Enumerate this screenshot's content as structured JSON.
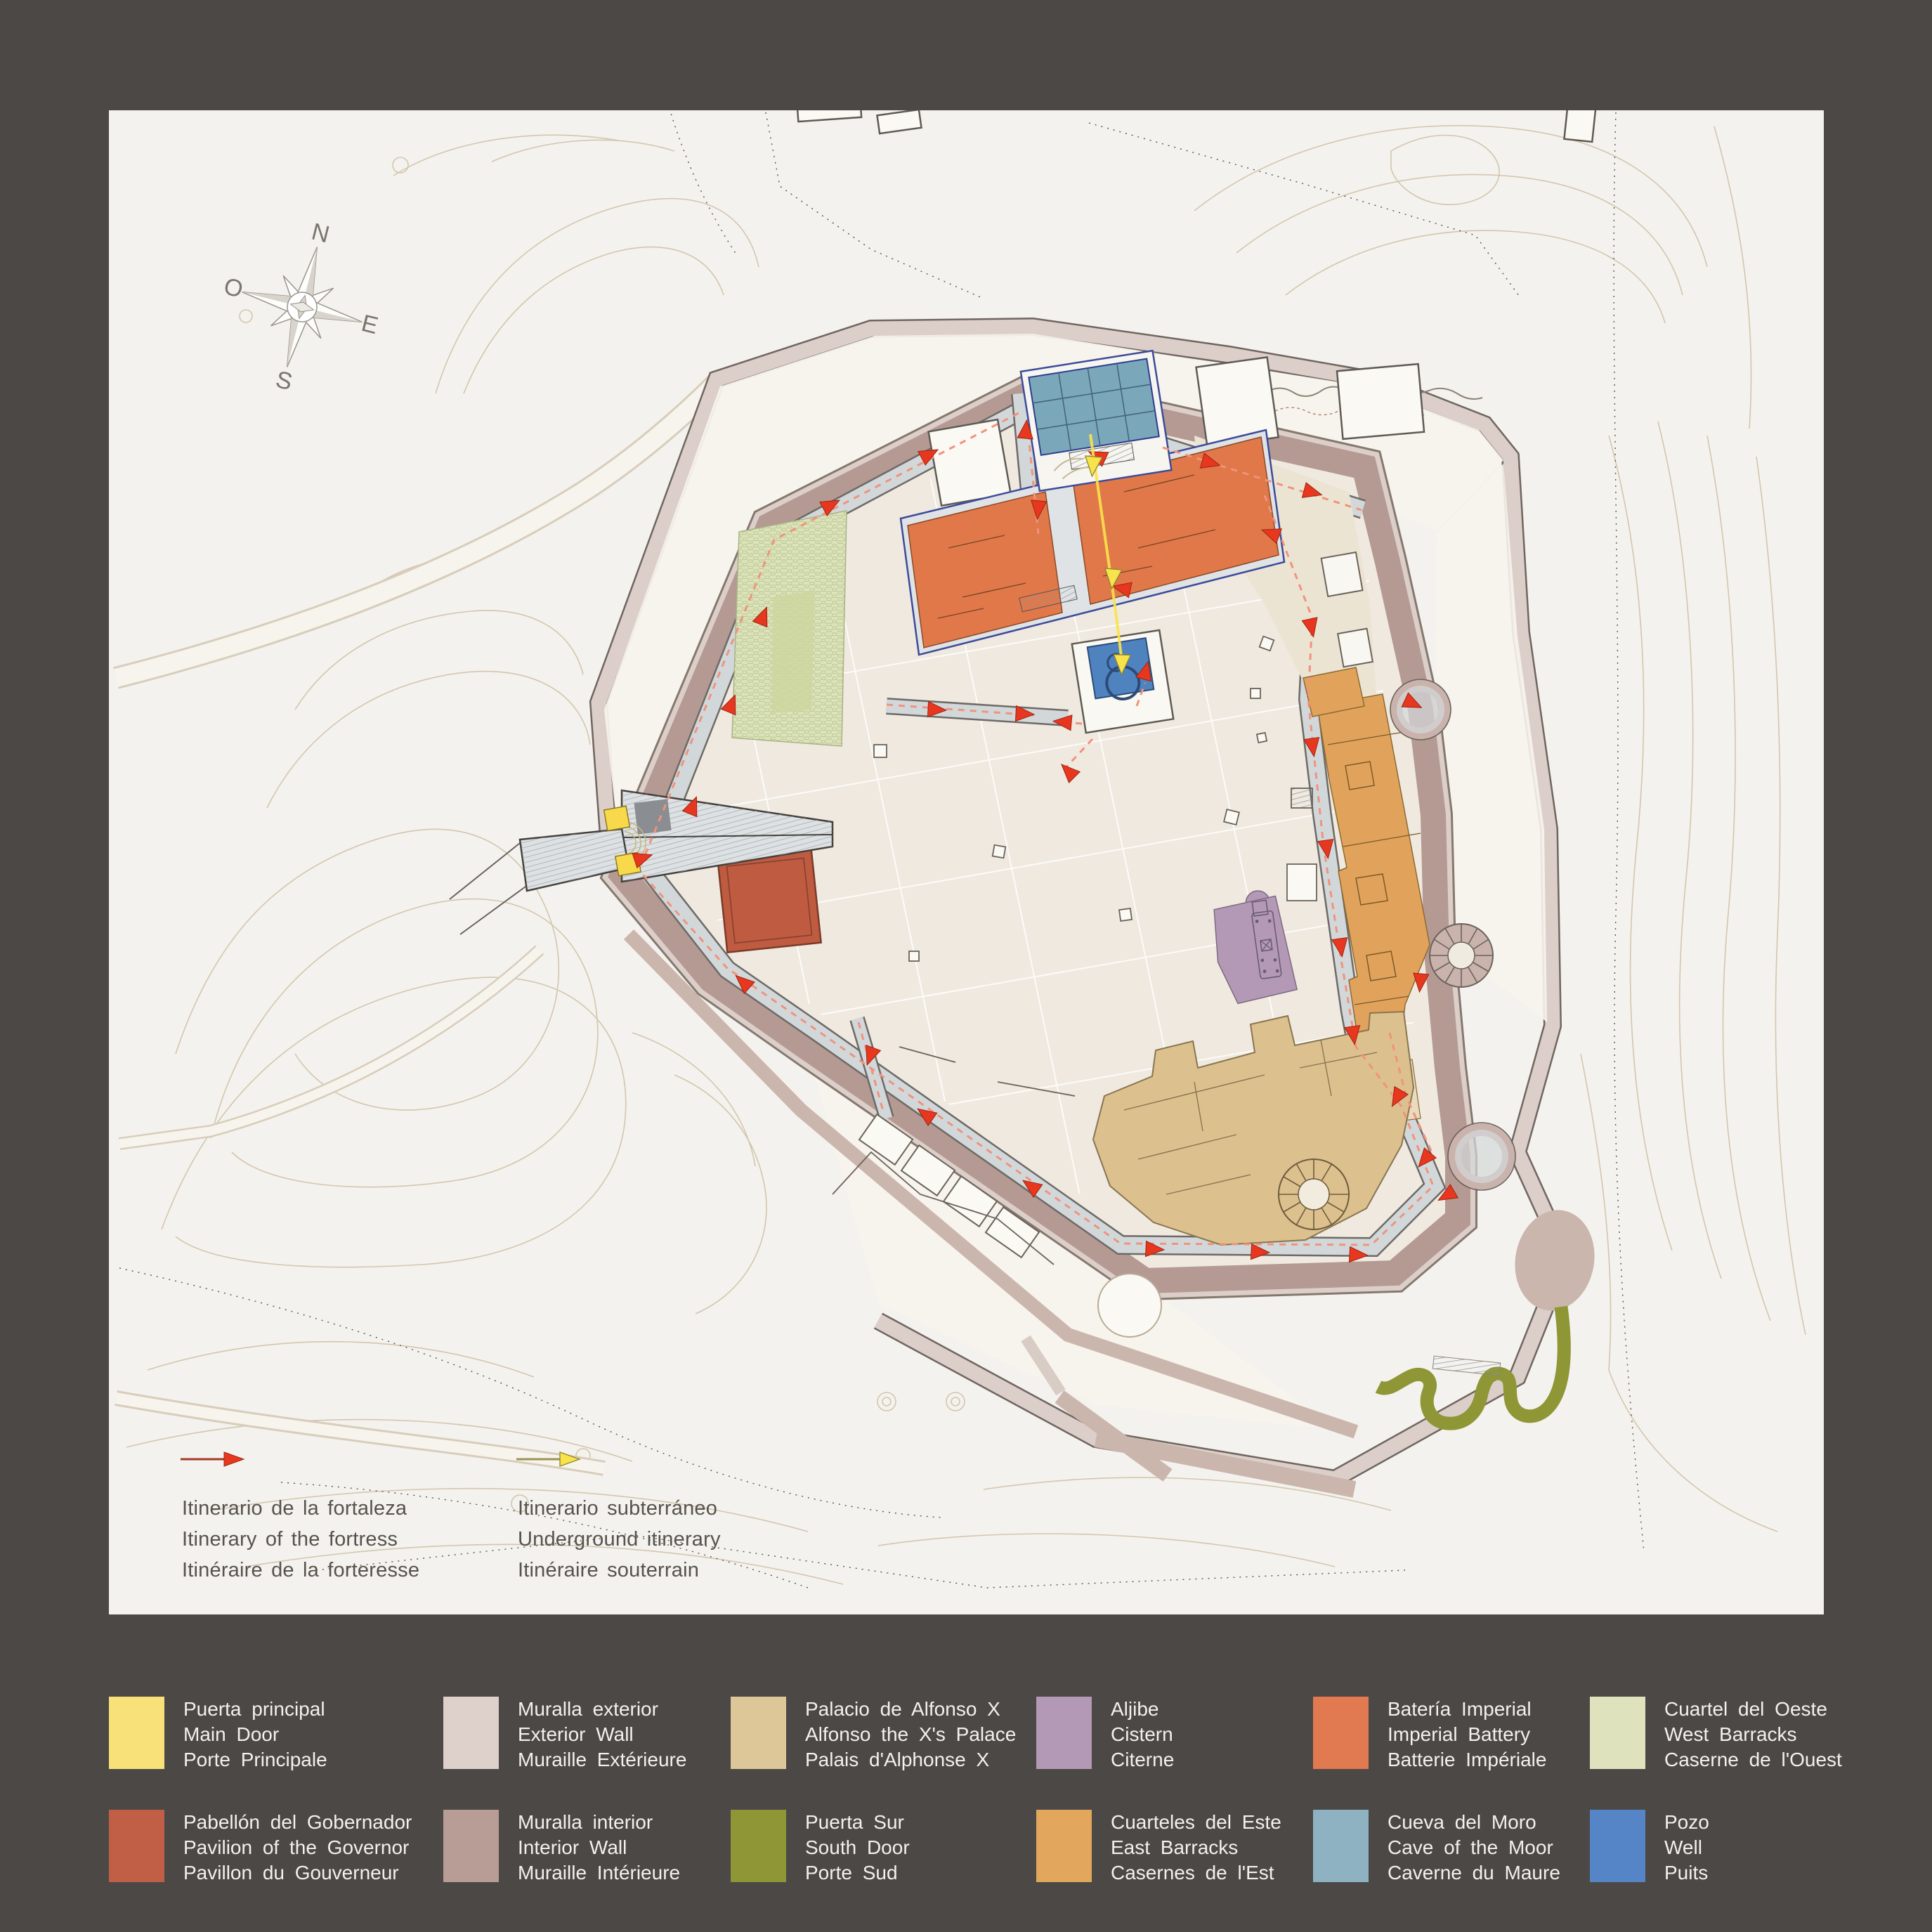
{
  "map": {
    "compass": {
      "n": "N",
      "e": "E",
      "s": "S",
      "o": "O"
    },
    "itinerary_legend": {
      "fortress": {
        "es": "Itinerario de la fortaleza",
        "en": "Itinerary of the fortress",
        "fr": "Itinéraire de la forteresse"
      },
      "underground": {
        "es": "Itinerario subterráneo",
        "en": "Underground itinerary",
        "fr": "Itinéraire souterrain"
      }
    }
  },
  "legend": {
    "items": [
      {
        "id": "puerta-principal",
        "color": "#f9e17a",
        "es": "Puerta principal",
        "en": "Main Door",
        "fr": "Porte Principale"
      },
      {
        "id": "pabellon-gobernador",
        "color": "#c05f45",
        "es": "Pabellón del Gobernador",
        "en": "Pavilion of the Governor",
        "fr": "Pavillon du Gouverneur"
      },
      {
        "id": "muralla-exterior",
        "color": "#ded0cb",
        "es": "Muralla exterior",
        "en": "Exterior Wall",
        "fr": "Muraille Extérieure"
      },
      {
        "id": "muralla-interior",
        "color": "#b79d96",
        "es": "Muralla interior",
        "en": "Interior Wall",
        "fr": "Muraille Intérieure"
      },
      {
        "id": "palacio-alfonso-x",
        "color": "#ddc697",
        "es": "Palacio de Alfonso X",
        "en": "Alfonso the X's Palace",
        "fr": "Palais d'Alphonse X"
      },
      {
        "id": "puerta-sur",
        "color": "#8f9636",
        "es": "Puerta Sur",
        "en": "South Door",
        "fr": "Porte Sud"
      },
      {
        "id": "aljibe",
        "color": "#b399b6",
        "es": "Aljibe",
        "en": "Cistern",
        "fr": "Citerne"
      },
      {
        "id": "cuarteles-este",
        "color": "#e2a65c",
        "es": "Cuarteles del Este",
        "en": "East Barracks",
        "fr": "Casernes de l'Est"
      },
      {
        "id": "bateria-imperial",
        "color": "#e17a50",
        "es": "Batería Imperial",
        "en": "Imperial Battery",
        "fr": "Batterie Impériale"
      },
      {
        "id": "cueva-moro",
        "color": "#8fb2c3",
        "es": "Cueva del Moro",
        "en": "Cave of the Moor",
        "fr": "Caverne du Maure"
      },
      {
        "id": "cuartel-oeste",
        "color": "#dfe3bd",
        "es": "Cuartel del Oeste",
        "en": "West Barracks",
        "fr": "Caserne de l'Ouest"
      },
      {
        "id": "pozo",
        "color": "#5585c6",
        "es": "Pozo",
        "en": "Well",
        "fr": "Puits"
      }
    ]
  },
  "colors": {
    "background": "#4b4846",
    "panel": "#f4f2ee",
    "terrace": "#f7f3ec",
    "courtyard": "#efe9df",
    "wall_exterior": "#dccfc9",
    "wall_interior": "#b49a93",
    "walkway": "#d2d8da",
    "route_fortress": "#e8371f",
    "route_underground": "#f9e34c",
    "main_door": "#f9d94c",
    "governor": "#bf5b41",
    "palace": "#dcc18f",
    "south_door": "#8f9636",
    "cistern": "#b399b6",
    "east_barracks": "#e1a35c",
    "imperial_battery": "#e0784a",
    "moor_cave": "#7ba7ba",
    "west_barracks": "#dce3bb",
    "well": "#4f83c0",
    "ne_rooms": "#ece4d3",
    "contour": "#cfc2a6",
    "map_text": "#57524c",
    "legend_text": "#f3f1ec"
  }
}
